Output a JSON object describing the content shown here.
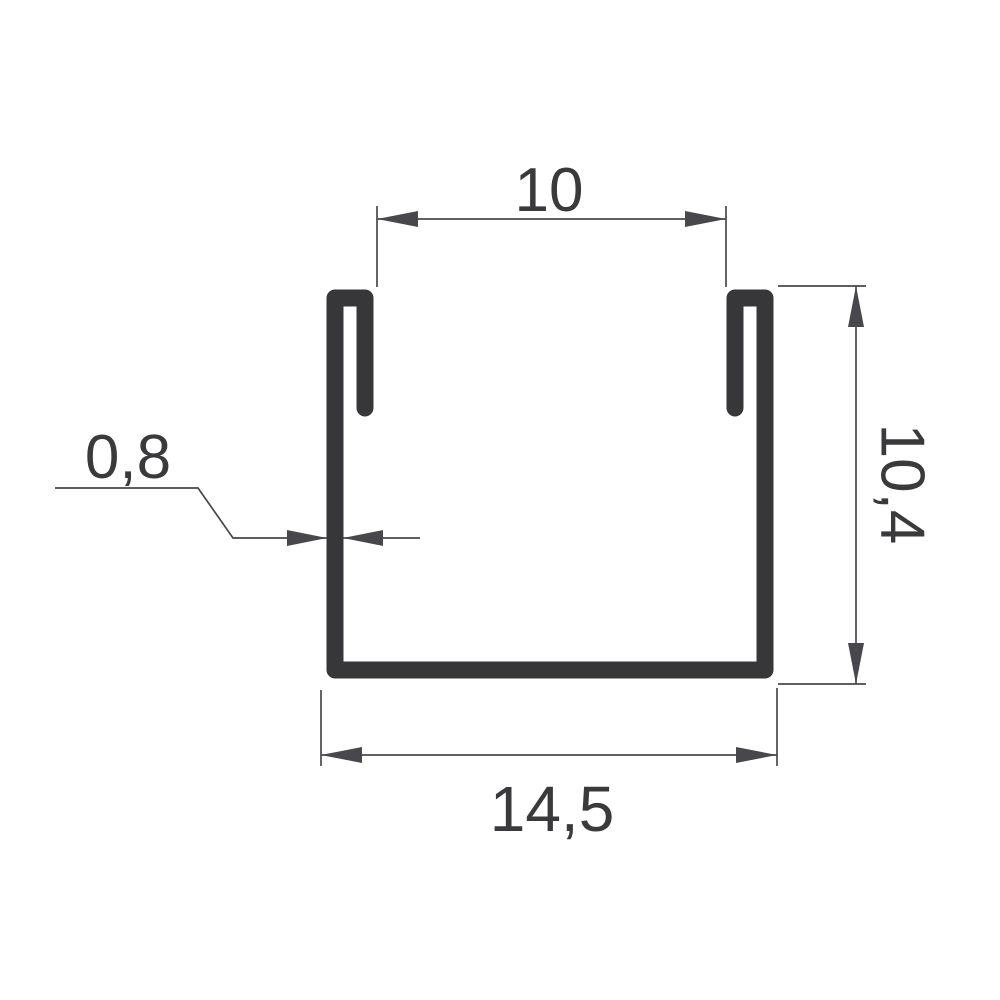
{
  "dimensions": {
    "inner_width": {
      "label": "10"
    },
    "height": {
      "label": "10,4"
    },
    "outer_width": {
      "label": "14,5"
    },
    "thickness": {
      "label": "0,8"
    }
  },
  "colors": {
    "profile": "#37373a",
    "dimension_lines": "#48484c",
    "text": "#3a3a3d",
    "background": "#ffffff"
  }
}
